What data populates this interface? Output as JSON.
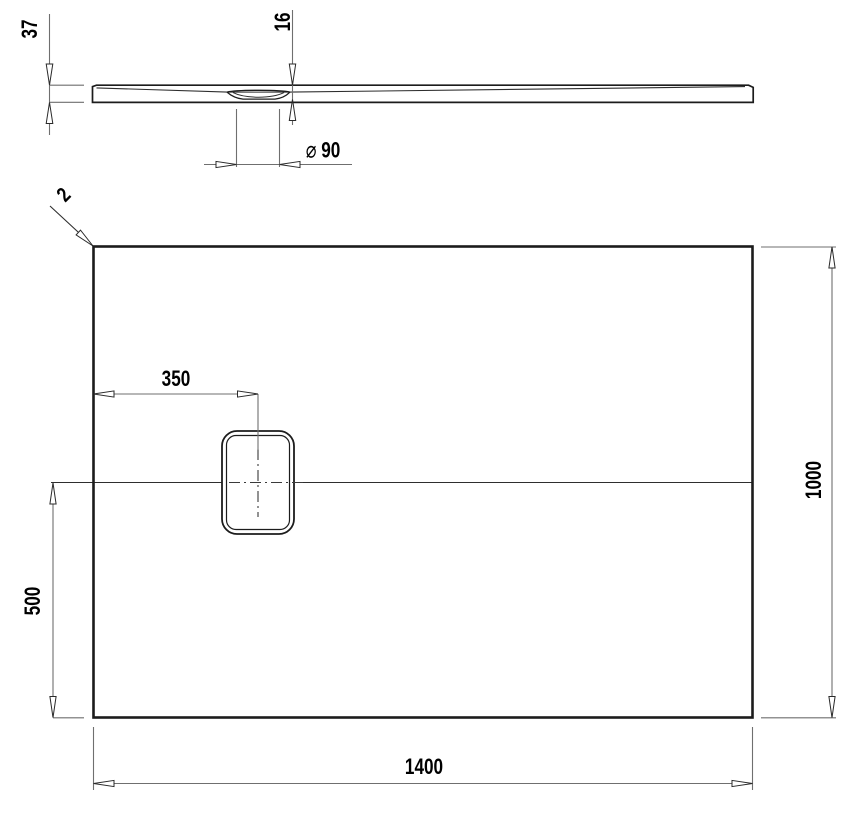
{
  "page": {
    "background": "#ffffff"
  },
  "colors": {
    "outline": "#1c1c1c",
    "thin_line": "#2e2e2e",
    "dim_line": "#6f6f6f",
    "text": "#000000"
  },
  "views": {
    "section_view": "side-section-profile-of-tray",
    "plan_view": "top-plan-of-tray-with-drain"
  },
  "dimensions": {
    "edge_height": {
      "value": "37"
    },
    "drain_recess_height": {
      "value": "16"
    },
    "drain_diameter": {
      "symbol": "⌀",
      "value": "90"
    },
    "corner_radius": {
      "value": "2"
    },
    "drain_center_from_left_edge": {
      "value": "350"
    },
    "drain_center_from_bottom_edge": {
      "value": "500"
    },
    "tray_width": {
      "value": "1000"
    },
    "tray_length": {
      "value": "1400"
    }
  }
}
